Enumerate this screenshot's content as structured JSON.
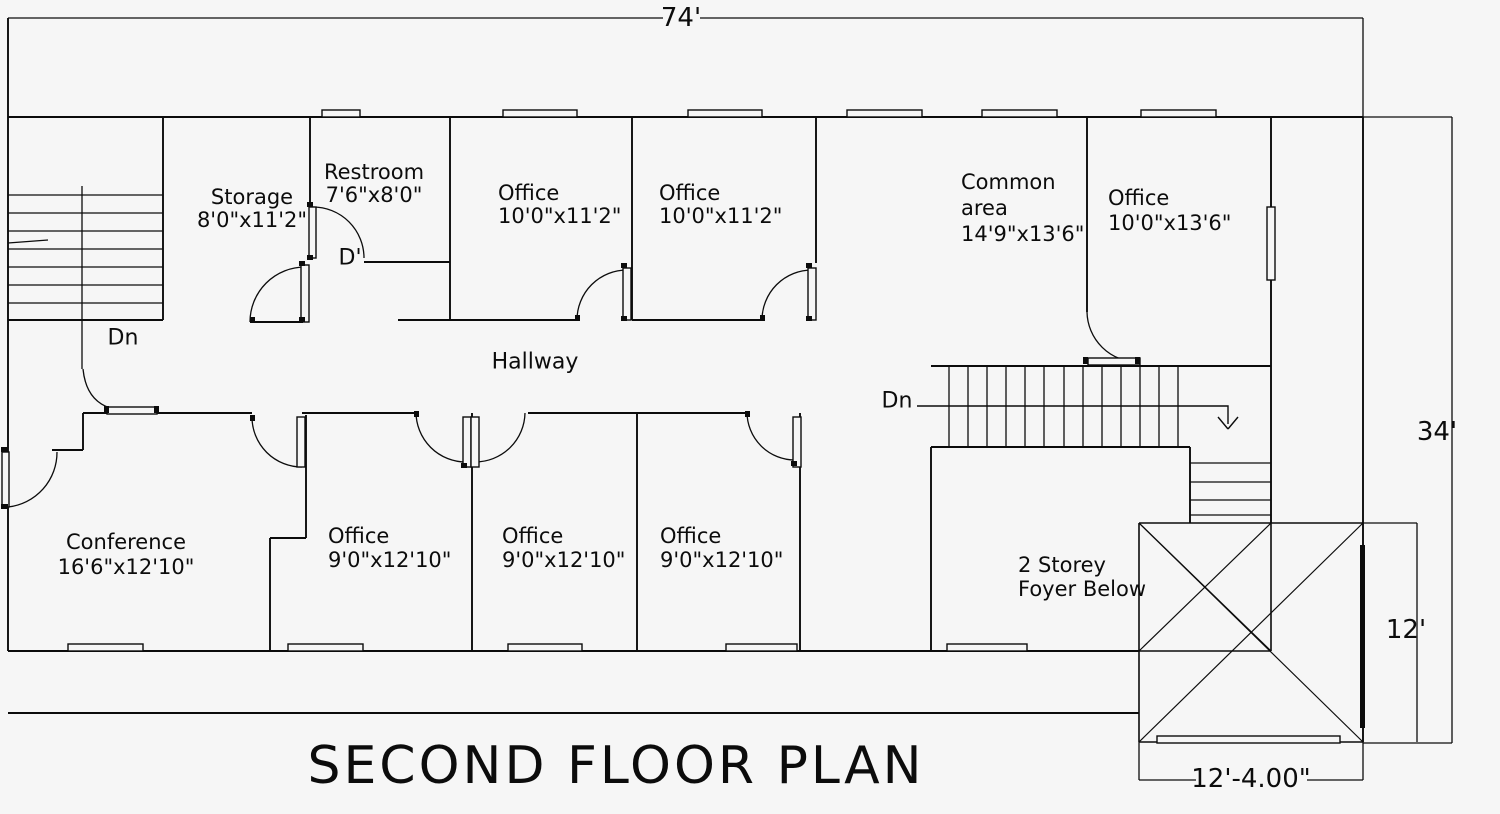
{
  "title": "SECOND FLOOR PLAN",
  "dims": {
    "width_total": "74'",
    "height_total": "34'",
    "foyer_height": "12'",
    "foyer_width": "12'-4.00\""
  },
  "rooms": {
    "storage": {
      "name": "Storage",
      "size": "8'0\"x11'2\""
    },
    "restroom": {
      "name": "Restroom",
      "size": "7'6\"x8'0\""
    },
    "office_top_1": {
      "name": "Office",
      "size": "10'0\"x11'2\""
    },
    "office_top_2": {
      "name": "Office",
      "size": "10'0\"x11'2\""
    },
    "common_area": {
      "name": "Common",
      "name2": "area",
      "size": "14'9\"x13'6\""
    },
    "office_top_3": {
      "name": "Office",
      "size": "10'0\"x13'6\""
    },
    "conference": {
      "name": "Conference",
      "size": "16'6\"x12'10\""
    },
    "office_bottom_1": {
      "name": "Office",
      "size": "9'0\"x12'10\""
    },
    "office_bottom_2": {
      "name": "Office",
      "size": "9'0\"x12'10\""
    },
    "office_bottom_3": {
      "name": "Office",
      "size": "9'0\"x12'10\""
    },
    "foyer": {
      "line1": "2 Storey",
      "line2": "Foyer Below"
    }
  },
  "annotations": {
    "hallway": "Hallway",
    "down_left": "Dn",
    "down_right": "Dn",
    "door_mark": "D'"
  }
}
